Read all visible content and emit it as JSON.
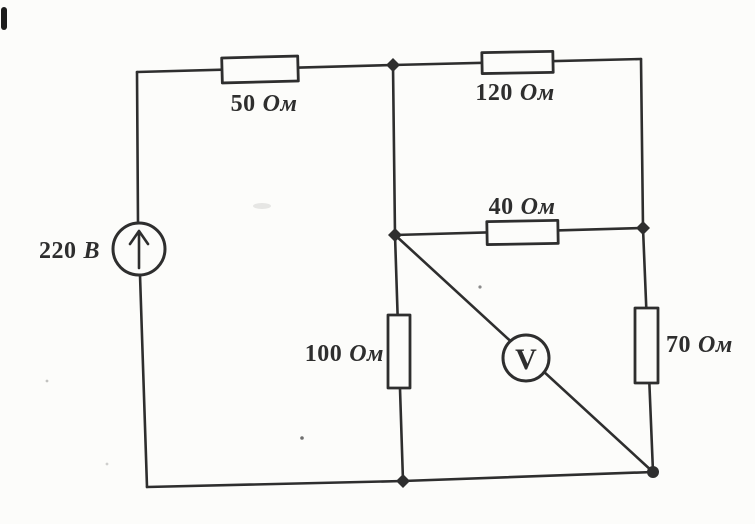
{
  "circuit": {
    "source": {
      "value": "220",
      "unit": "В",
      "symbol": "source-circle-up-arrow"
    },
    "resistors": {
      "r50": {
        "value": "50",
        "unit": "Ом"
      },
      "r120": {
        "value": "120",
        "unit": "Ом"
      },
      "r40": {
        "value": "40",
        "unit": "Ом"
      },
      "r100": {
        "value": "100",
        "unit": "Ом"
      },
      "r70": {
        "value": "70",
        "unit": "Ом"
      }
    },
    "voltmeter": {
      "label": "V",
      "symbol": "voltmeter-circle"
    },
    "ink_color": "#2e2e2e",
    "paper_color": "#fcfcfa"
  }
}
